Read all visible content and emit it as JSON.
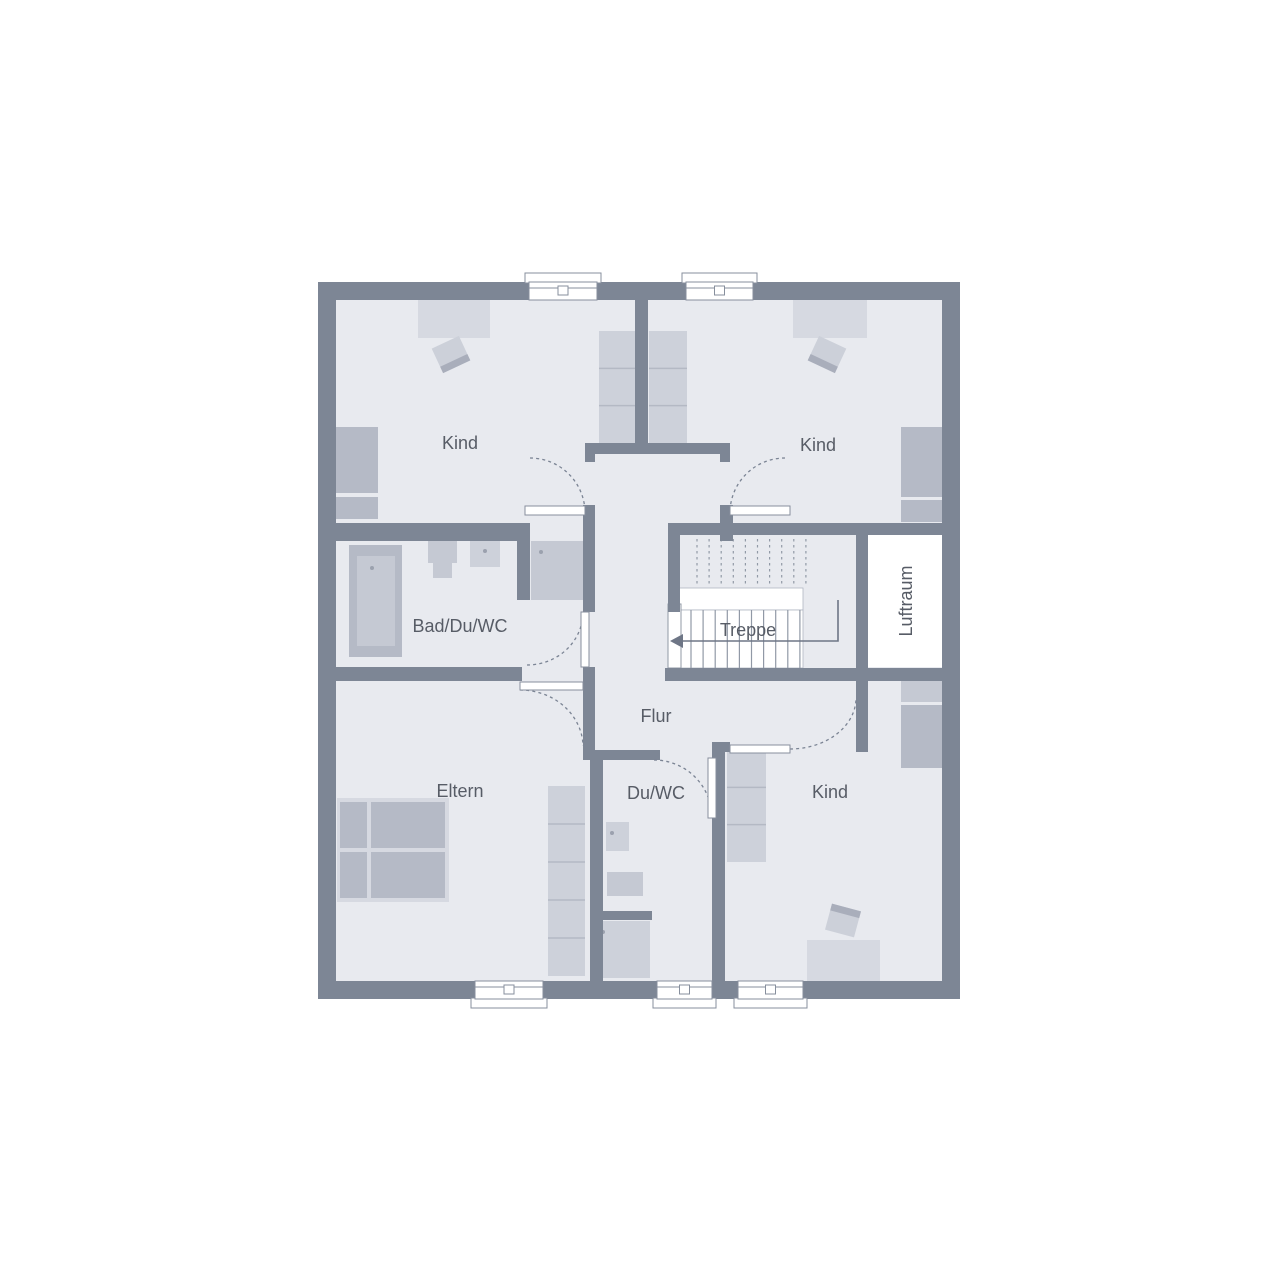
{
  "colors": {
    "background": "#ffffff",
    "wall": "#7d8695",
    "floor": "#e8eaef",
    "white": "#ffffff",
    "furniture_light": "#d6d9e1",
    "furniture_shelf": "#cdd1da",
    "furniture_mid": "#c5c9d3",
    "furniture_dark": "#b5bac6",
    "chair": "#ccd0d9",
    "chair_stripe": "#a9aebb",
    "window_border": "#878f9d",
    "tread_line": "#9199a6",
    "stair_outline": "#b0b6c2",
    "dash": "#7b8494",
    "arrow": "#6e7686",
    "divider_line": "#b4b9c4",
    "label_text": "#575c66",
    "dot": "#9ba1ae"
  },
  "labels": {
    "kind_top_left": "Kind",
    "kind_top_right": "Kind",
    "bad": "Bad/Du/WC",
    "treppe": "Treppe",
    "luftraum": "Luftraum",
    "flur": "Flur",
    "eltern": "Eltern",
    "du_wc": "Du/WC",
    "kind_bottom": "Kind"
  },
  "plan": {
    "outer": [
      318,
      282,
      642,
      717
    ],
    "floor": [
      336,
      300,
      606,
      681
    ],
    "walls": [
      {
        "name": "wall-divider-top",
        "r": [
          635,
          300,
          13,
          145
        ]
      },
      {
        "name": "wall-hall-cap",
        "r": [
          585,
          443,
          145,
          11
        ]
      },
      {
        "name": "wall-hall-cap-flange-left",
        "r": [
          585,
          443,
          10,
          19
        ]
      },
      {
        "name": "wall-hall-cap-flange-right",
        "r": [
          720,
          443,
          10,
          19
        ]
      },
      {
        "name": "wall-hall-left-stub",
        "r": [
          583,
          505,
          12,
          107
        ]
      },
      {
        "name": "wall-hall-right-stub",
        "r": [
          720,
          505,
          13,
          36
        ]
      },
      {
        "name": "wall-bad-top",
        "r": [
          336,
          523,
          192,
          18
        ]
      },
      {
        "name": "wall-bad-partition",
        "r": [
          517,
          523,
          13,
          77
        ]
      },
      {
        "name": "wall-bad-bottom",
        "r": [
          336,
          667,
          186,
          14
        ]
      },
      {
        "name": "wall-flur-left",
        "r": [
          583,
          667,
          12,
          93
        ]
      },
      {
        "name": "wall-duwc-top",
        "r": [
          595,
          750,
          65,
          10
        ]
      },
      {
        "name": "wall-duwc-left",
        "r": [
          590,
          758,
          13,
          223
        ]
      },
      {
        "name": "wall-duwc-right",
        "r": [
          712,
          742,
          13,
          239
        ]
      },
      {
        "name": "wall-kind-bottom-corner",
        "r": [
          712,
          742,
          18,
          10
        ]
      },
      {
        "name": "wall-stair-top",
        "r": [
          668,
          523,
          280,
          12
        ]
      },
      {
        "name": "wall-stair-left",
        "r": [
          668,
          523,
          12,
          89
        ]
      },
      {
        "name": "wall-stair-bottom",
        "r": [
          665,
          668,
          283,
          13
        ]
      },
      {
        "name": "wall-luftraum-left",
        "r": [
          856,
          532,
          12,
          136
        ]
      },
      {
        "name": "wall-kind-bottom-stub",
        "r": [
          856,
          681,
          12,
          71
        ]
      },
      {
        "name": "wall-duwc-shower-partition",
        "r": [
          592,
          911,
          60,
          9
        ]
      }
    ],
    "windows": [
      {
        "name": "window-kind-top-left",
        "r": [
          529,
          282,
          68,
          18
        ],
        "side": "top"
      },
      {
        "name": "window-kind-top-right",
        "r": [
          686,
          282,
          67,
          18
        ],
        "side": "top"
      },
      {
        "name": "window-eltern",
        "r": [
          475,
          981,
          68,
          18
        ],
        "side": "bottom"
      },
      {
        "name": "window-duwc",
        "r": [
          657,
          981,
          55,
          18
        ],
        "side": "bottom"
      },
      {
        "name": "window-kind-bottom",
        "r": [
          738,
          981,
          65,
          18
        ],
        "side": "bottom"
      }
    ],
    "doors": [
      {
        "name": "door-kind-top-left",
        "leaf": [
          525,
          506,
          60,
          9
        ],
        "arc": "M530,458 A55,55 0 0 1 585,512"
      },
      {
        "name": "door-kind-top-right",
        "leaf": [
          730,
          506,
          60,
          9
        ],
        "arc": "M785,458 A55,55 0 0 0 730,512"
      },
      {
        "name": "door-bad",
        "leaf": [
          581,
          612,
          8,
          55
        ],
        "arc": "M527,665 A56,53 0 0 0 583,612"
      },
      {
        "name": "door-eltern",
        "leaf": [
          520,
          682,
          63,
          8
        ],
        "arc": "M520,690 A63,57 0 0 1 583,746"
      },
      {
        "name": "door-duwc",
        "leaf": [
          708,
          758,
          8,
          60
        ],
        "arc": "M654,760 A58,58 0 0 1 712,818"
      },
      {
        "name": "door-kind-bottom",
        "leaf": [
          730,
          745,
          60,
          8
        ],
        "arc": "M790,749 A66,51 0 0 0 856,698"
      }
    ],
    "stairs": {
      "dash_treads": {
        "x0": 697,
        "step": 12.1,
        "count": 10,
        "y0": 539,
        "y1": 586
      },
      "landing": [
        679,
        588,
        124,
        22
      ],
      "lower": [
        679,
        610,
        124,
        58
      ],
      "lower_treads": {
        "x0": 691,
        "step": 12.1,
        "count": 10,
        "y0": 610,
        "y1": 668
      },
      "entry_box": [
        668,
        604,
        13,
        64
      ],
      "arrow_path": "M838,600 L838,641 L682,641",
      "arrow_head": "670,641 683,634 683,648"
    },
    "luftraum_box": [
      868,
      535,
      74,
      132
    ],
    "furniture": [
      {
        "type": "rect",
        "name": "desk",
        "r": [
          418,
          300,
          72,
          38
        ],
        "fill": "furniture_light"
      },
      {
        "type": "chair",
        "name": "desk-chair",
        "r": [
          436,
          341,
          30,
          27
        ],
        "rot": -25,
        "stripe": "bottom"
      },
      {
        "type": "rect",
        "name": "bed",
        "r": [
          336,
          427,
          42,
          66
        ],
        "fill": "furniture_dark"
      },
      {
        "type": "rect",
        "name": "bed-pillow",
        "r": [
          336,
          497,
          42,
          22
        ],
        "fill": "furniture_dark"
      },
      {
        "type": "shelf",
        "name": "wardrobe",
        "r": [
          599,
          331,
          38,
          112
        ],
        "sections": 3
      },
      {
        "type": "shelf",
        "name": "wardrobe",
        "r": [
          649,
          331,
          38,
          112
        ],
        "sections": 3
      },
      {
        "type": "rect",
        "name": "desk",
        "r": [
          793,
          300,
          74,
          38
        ],
        "fill": "furniture_light"
      },
      {
        "type": "chair",
        "name": "desk-chair",
        "r": [
          812,
          341,
          30,
          27
        ],
        "rot": 25,
        "stripe": "bottom"
      },
      {
        "type": "rect",
        "name": "bed",
        "r": [
          901,
          427,
          41,
          70
        ],
        "fill": "furniture_dark"
      },
      {
        "type": "rect",
        "name": "bed-pillow",
        "r": [
          901,
          500,
          41,
          22
        ],
        "fill": "furniture_dark"
      },
      {
        "type": "tub",
        "name": "bathtub",
        "r": [
          349,
          545,
          53,
          112
        ],
        "inner": [
          357,
          556,
          38,
          90
        ],
        "dot": [
          372,
          568
        ]
      },
      {
        "type": "rect",
        "name": "sink",
        "r": [
          428,
          541,
          29,
          22
        ],
        "fill": "furniture_mid"
      },
      {
        "type": "rect",
        "name": "sink-basin",
        "r": [
          433,
          563,
          19,
          15
        ],
        "fill": "furniture_mid"
      },
      {
        "type": "rect",
        "name": "toilet",
        "r": [
          470,
          541,
          30,
          26
        ],
        "fill": "furniture_shelf",
        "dot": [
          485,
          551
        ]
      },
      {
        "type": "rect",
        "name": "shower",
        "r": [
          531,
          541,
          52,
          59
        ],
        "fill": "furniture_mid",
        "dot": [
          541,
          552
        ]
      },
      {
        "type": "bed2",
        "name": "double-bed",
        "frame": [
          337,
          798,
          112,
          104
        ],
        "parts": [
          [
            340,
            802,
            27,
            46
          ],
          [
            340,
            852,
            27,
            46
          ],
          [
            371,
            802,
            74,
            46
          ],
          [
            371,
            852,
            74,
            46
          ]
        ]
      },
      {
        "type": "shelf",
        "name": "wardrobe",
        "r": [
          548,
          786,
          37,
          190
        ],
        "sections": 5
      },
      {
        "type": "rect",
        "name": "toilet",
        "r": [
          606,
          822,
          23,
          29
        ],
        "fill": "furniture_shelf",
        "dot": [
          612,
          833
        ]
      },
      {
        "type": "rect",
        "name": "sink",
        "r": [
          607,
          872,
          36,
          24
        ],
        "fill": "furniture_mid"
      },
      {
        "type": "rect",
        "name": "shower-tray",
        "r": [
          594,
          921,
          56,
          57
        ],
        "fill": "furniture_shelf",
        "dot": [
          603,
          932
        ]
      },
      {
        "type": "shelf",
        "name": "shelf",
        "r": [
          727,
          750,
          39,
          112
        ],
        "sections": 3
      },
      {
        "type": "rect",
        "name": "bed-pillow",
        "r": [
          901,
          677,
          41,
          25
        ],
        "fill": "furniture_mid"
      },
      {
        "type": "rect",
        "name": "bed",
        "r": [
          901,
          705,
          41,
          63
        ],
        "fill": "furniture_dark"
      },
      {
        "type": "rect",
        "name": "desk",
        "r": [
          807,
          940,
          73,
          41
        ],
        "fill": "furniture_light"
      },
      {
        "type": "chair",
        "name": "desk-chair",
        "r": [
          828,
          907,
          30,
          27
        ],
        "rot": 15,
        "stripe": "top"
      }
    ],
    "label_pos": [
      {
        "key": "kind_top_left",
        "x": 460,
        "y": 443
      },
      {
        "key": "kind_top_right",
        "x": 818,
        "y": 445
      },
      {
        "key": "bad",
        "x": 460,
        "y": 626
      },
      {
        "key": "treppe",
        "x": 748,
        "y": 630
      },
      {
        "key": "luftraum",
        "x": 906,
        "y": 601,
        "rot": -90
      },
      {
        "key": "flur",
        "x": 656,
        "y": 716
      },
      {
        "key": "eltern",
        "x": 460,
        "y": 791
      },
      {
        "key": "du_wc",
        "x": 656,
        "y": 793
      },
      {
        "key": "kind_bottom",
        "x": 830,
        "y": 792
      }
    ]
  }
}
